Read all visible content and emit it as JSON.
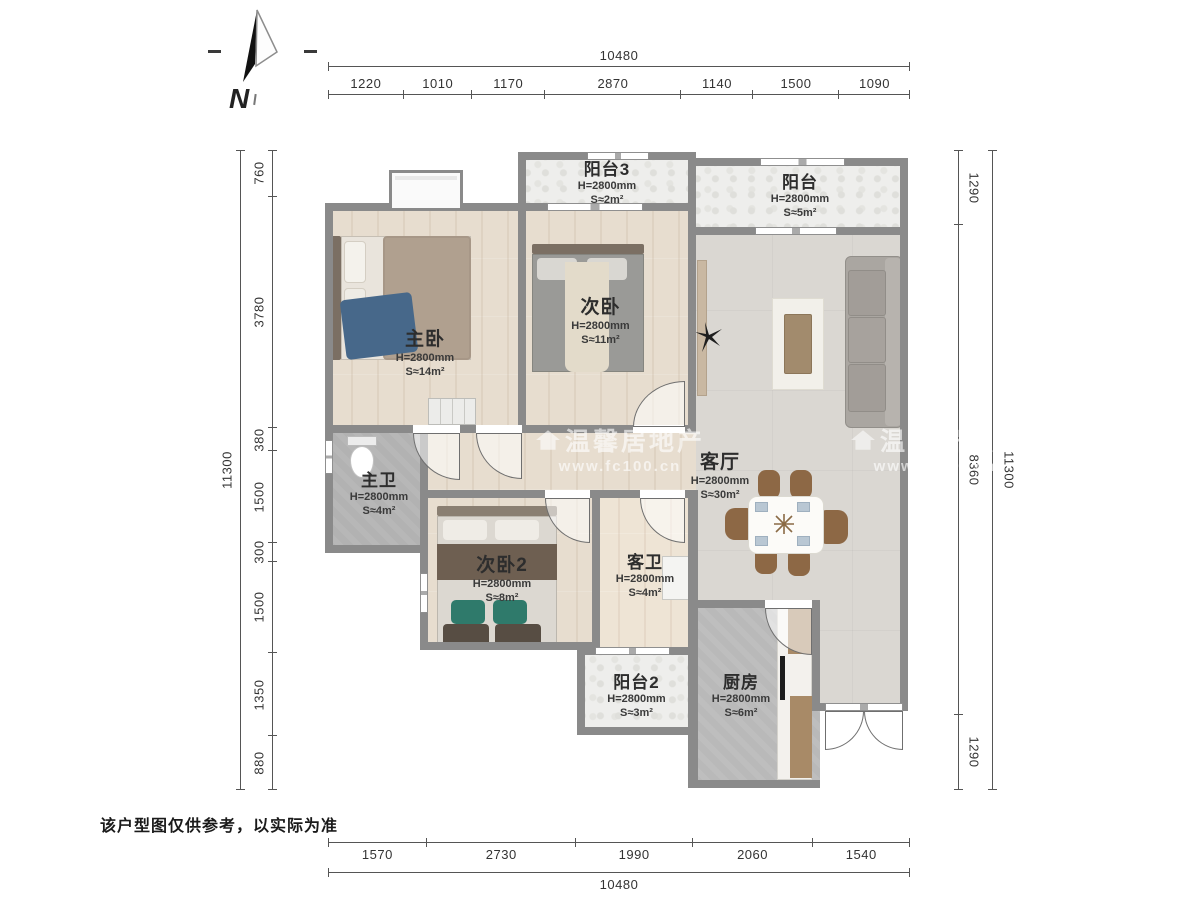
{
  "north": {
    "label": "N"
  },
  "watermark": {
    "brand": "温馨居地产",
    "site": "www.fc100.cn"
  },
  "disclaimer": "该户型图仅供参考，以实际为准",
  "dimensions": {
    "top": {
      "total": "10480",
      "segments": [
        "1220",
        "1010",
        "1170",
        "2870",
        "1140",
        "1500",
        "1090"
      ]
    },
    "bottom": {
      "total": "10480",
      "segments": [
        "1570",
        "2730",
        "1990",
        "2060",
        "1540"
      ]
    },
    "left": {
      "total": "11300",
      "segments": [
        "760",
        "3780",
        "380",
        "1500",
        "300",
        "1500",
        "1350",
        "880"
      ]
    },
    "right": {
      "total": "11300",
      "segments": [
        "1290",
        "8360",
        "1290"
      ]
    }
  },
  "rooms": {
    "balcony3": {
      "name": "阳台3",
      "height": "H=2800mm",
      "area": "S≈2m²"
    },
    "balcony": {
      "name": "阳台",
      "height": "H=2800mm",
      "area": "S≈5m²"
    },
    "master_bedroom": {
      "name": "主卧",
      "height": "H=2800mm",
      "area": "S≈14m²"
    },
    "bedroom2": {
      "name": "次卧",
      "height": "H=2800mm",
      "area": "S≈11m²"
    },
    "living_room": {
      "name": "客厅",
      "height": "H=2800mm",
      "area": "S≈30m²"
    },
    "master_bath": {
      "name": "主卫",
      "height": "H=2800mm",
      "area": "S≈4m²"
    },
    "bedroom3": {
      "name": "次卧2",
      "height": "H=2800mm",
      "area": "S≈8m²"
    },
    "guest_bath": {
      "name": "客卫",
      "height": "H=2800mm",
      "area": "S≈4m²"
    },
    "balcony2": {
      "name": "阳台2",
      "height": "H=2800mm",
      "area": "S≈3m²"
    },
    "kitchen": {
      "name": "厨房",
      "height": "H=2800mm",
      "area": "S≈6m²"
    }
  },
  "colors": {
    "wall": "#8a8a8a",
    "wood_floor": "#e7ddcf",
    "tile_floor": "#b2b2b2",
    "balcony_floor": "#eeeeec",
    "living_floor": "#dad7d2",
    "kitchen_floor": "#b9b9b9",
    "dim_text": "#333333",
    "accent_bed_blue": "#47688a",
    "accent_pillow_green": "#2f7a6b",
    "chair_brown": "#8d6845"
  }
}
